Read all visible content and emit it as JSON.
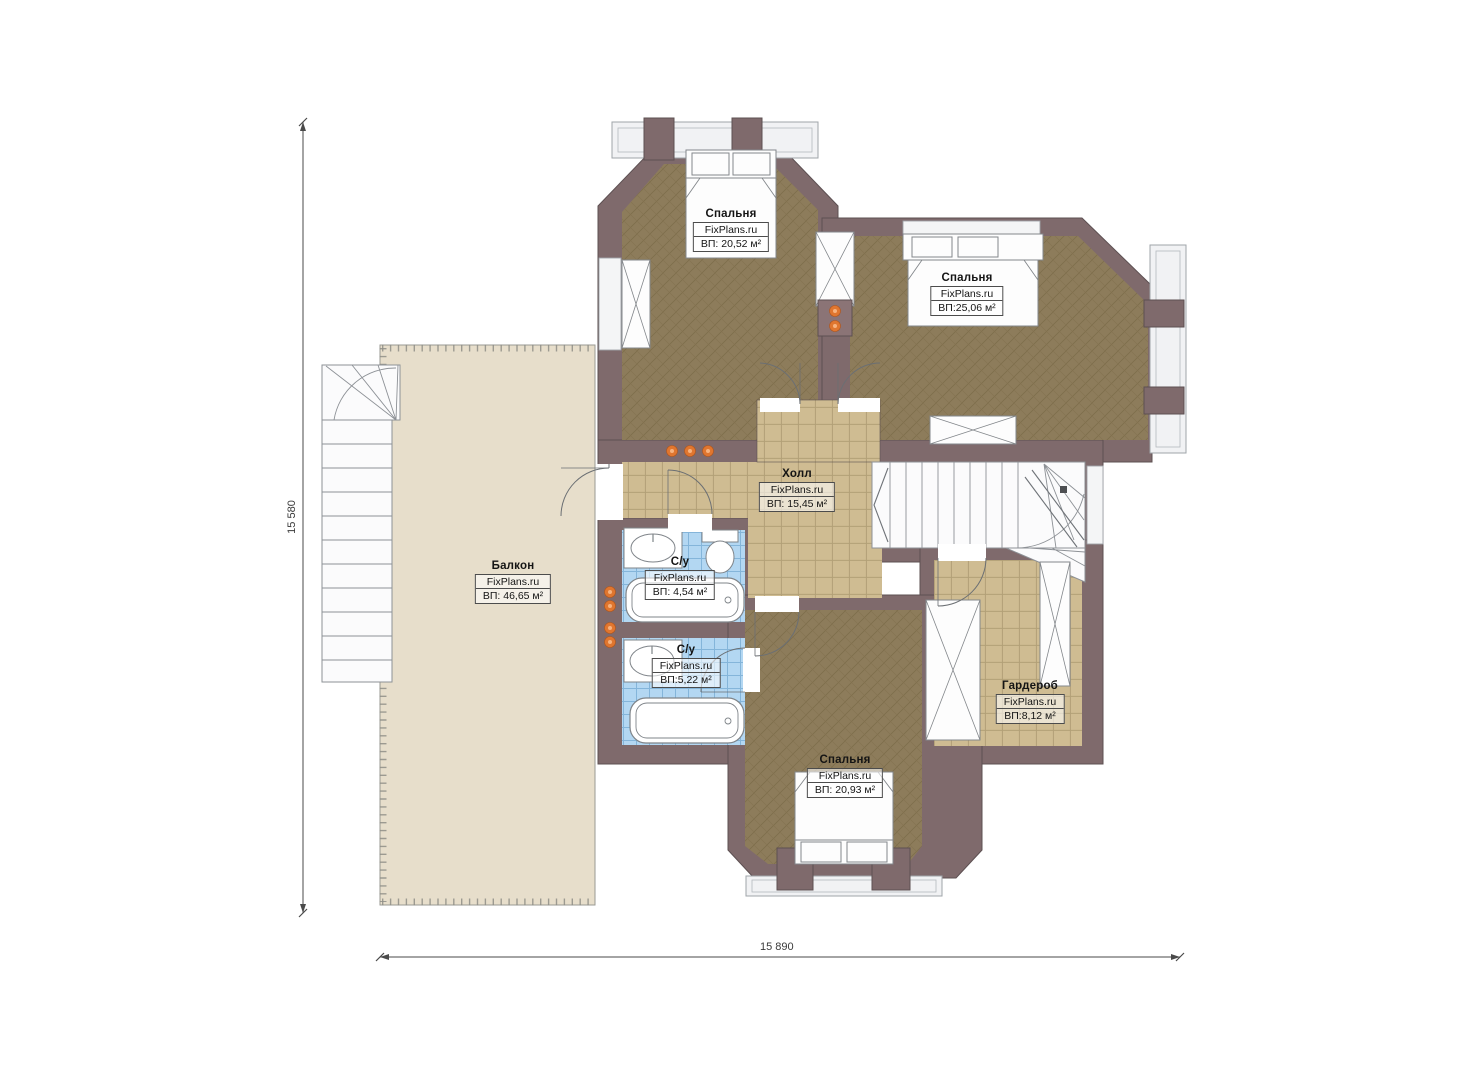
{
  "watermark": "FixPlans.ru",
  "dimensions": {
    "vertical": "15 580",
    "horizontal": "15 890"
  },
  "rooms": [
    {
      "name": "Спальня",
      "brand": "FixPlans.ru",
      "area": "ВП: 20,52 м²"
    },
    {
      "name": "Спальня",
      "brand": "FixPlans.ru",
      "area": "ВП:25,06 м²"
    },
    {
      "name": "Холл",
      "brand": "FixPlans.ru",
      "area": "ВП: 15,45 м²"
    },
    {
      "name": "Балкон",
      "brand": "FixPlans.ru",
      "area": "ВП: 46,65 м²"
    },
    {
      "name": "С/у",
      "brand": "FixPlans.ru",
      "area": "ВП: 4,54 м²"
    },
    {
      "name": "С/у",
      "brand": "FixPlans.ru",
      "area": "ВП:5,22 м²"
    },
    {
      "name": "Гардероб",
      "brand": "FixPlans.ru",
      "area": "ВП:8,12 м²"
    },
    {
      "name": "Спальня",
      "brand": "FixPlans.ru",
      "area": "ВП: 20,93 м²"
    }
  ],
  "colors": {
    "wall": "#7f6a6c",
    "bedroom_floor": "#8d7c5b",
    "tile_floor": "#cfbc92",
    "bath_floor": "#b3d7f2",
    "balcony_floor": "#e7decb",
    "bay_band": "#f1f2f4",
    "accent_dot": "#e0762f"
  }
}
